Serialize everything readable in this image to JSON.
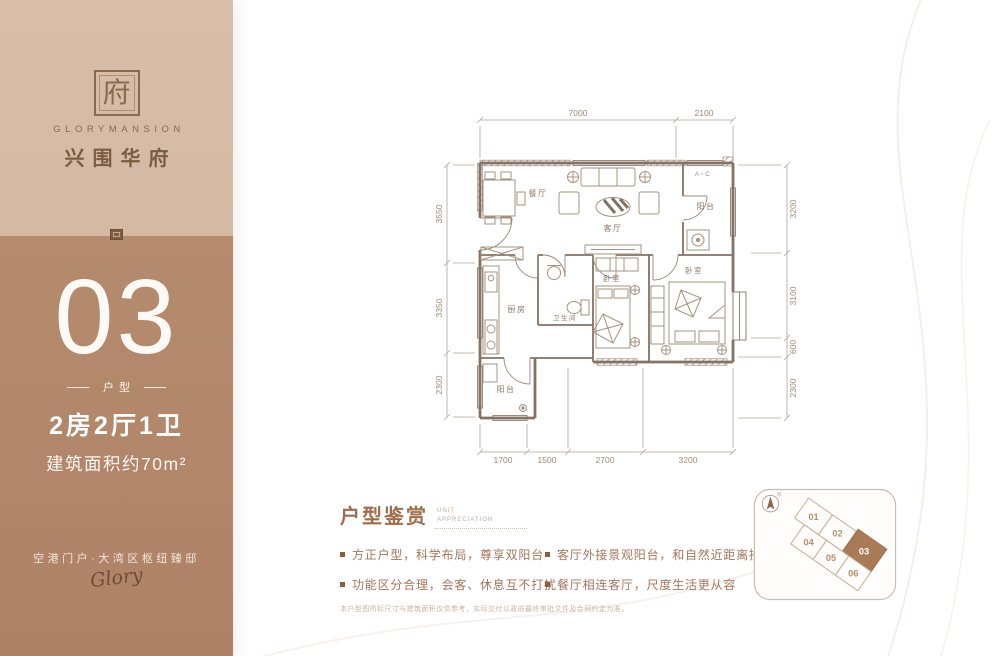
{
  "sidebar": {
    "brand": {
      "seal_glyph": "府",
      "name_en": "GLORYMANSION",
      "name_cn": "兴围华府"
    },
    "unit": {
      "number": "03",
      "type_label": "户型",
      "layout": "2房2厅1卫",
      "area": "建筑面积约70m²"
    },
    "tagline": "空港门户·大湾区枢纽臻邸",
    "signature": "Glory"
  },
  "floorplan": {
    "rooms": {
      "dining": "餐厅",
      "living": "客厅",
      "balcony_top": "阳台",
      "kitchen": "厨房",
      "bath": "卫生间",
      "bedroom_small": "卧室",
      "bedroom_master": "卧室",
      "balcony_bottom": "阳台",
      "ac": "A~C"
    },
    "dimensions": {
      "top": [
        "7000",
        "2100"
      ],
      "left": [
        "3550",
        "3350",
        "2300"
      ],
      "right": [
        "3200",
        "3100",
        "600",
        "2300"
      ],
      "bottom": [
        "1700",
        "1500",
        "2700",
        "3200"
      ]
    }
  },
  "appreciation": {
    "title": "户型鉴赏",
    "subtitle_line1": "UNIT",
    "subtitle_line2": "APPRECIATION",
    "bullets_left": [
      "方正户型，科学布局，尊享双阳台",
      "功能区分合理，会客、休息互不打扰"
    ],
    "bullets_right": [
      "客厅外接景观阳台，和自然近距离接触",
      "餐厅相连客厅，尺度生活更从容"
    ],
    "disclaimer": "本户型图所标尺寸与建筑面积仅供参考，实际交付以政府最终审批文件及合同约定为准。"
  },
  "keyplan": {
    "north_label": "N",
    "units": [
      "01",
      "02",
      "03",
      "04",
      "05",
      "06"
    ],
    "highlighted_unit": "03"
  },
  "colors": {
    "sidebar_top": "#d6bca7",
    "sidebar_bottom": "#b3886b",
    "brand_brown": "#8a6a4e",
    "accent_text": "#a06c4a",
    "bullet_text": "#a6765a",
    "plan_line": "#857263",
    "keyplan_highlight": "#a87a58"
  }
}
